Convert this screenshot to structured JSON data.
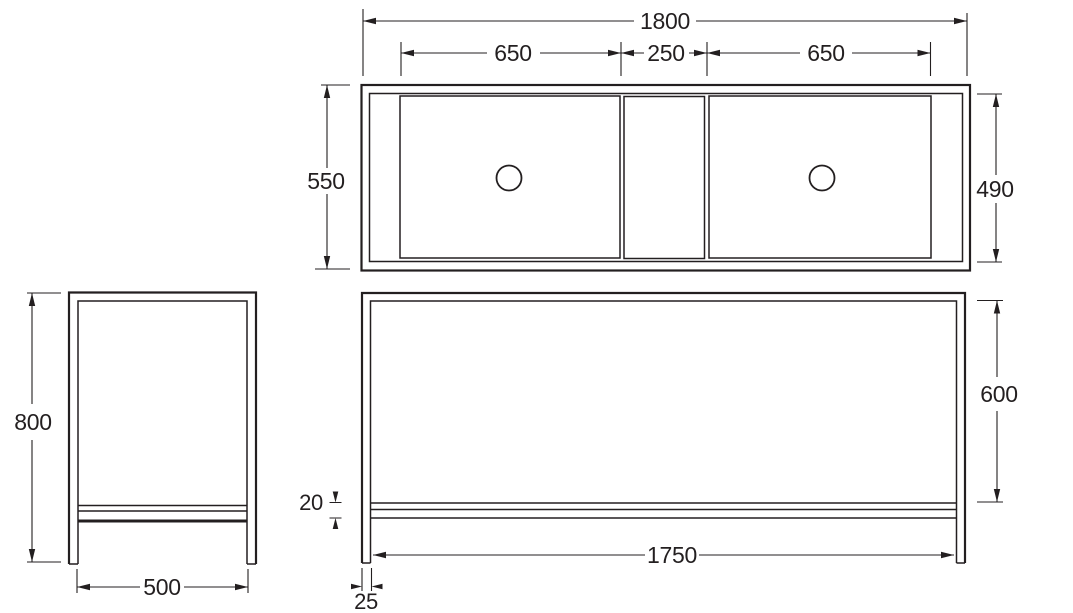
{
  "colors": {
    "line": "#231f20",
    "background": "#ffffff"
  },
  "top_view": {
    "overall_width": "1800",
    "left_bowl_width": "650",
    "center_section_width": "250",
    "right_bowl_width": "650",
    "overall_depth": "550",
    "bowl_depth": "490"
  },
  "side_view": {
    "overall_height": "800",
    "overall_depth": "500"
  },
  "front_view": {
    "clearance_height": "600",
    "rail_thickness": "20",
    "span_between_legs": "1750",
    "leg_thickness": "25"
  }
}
